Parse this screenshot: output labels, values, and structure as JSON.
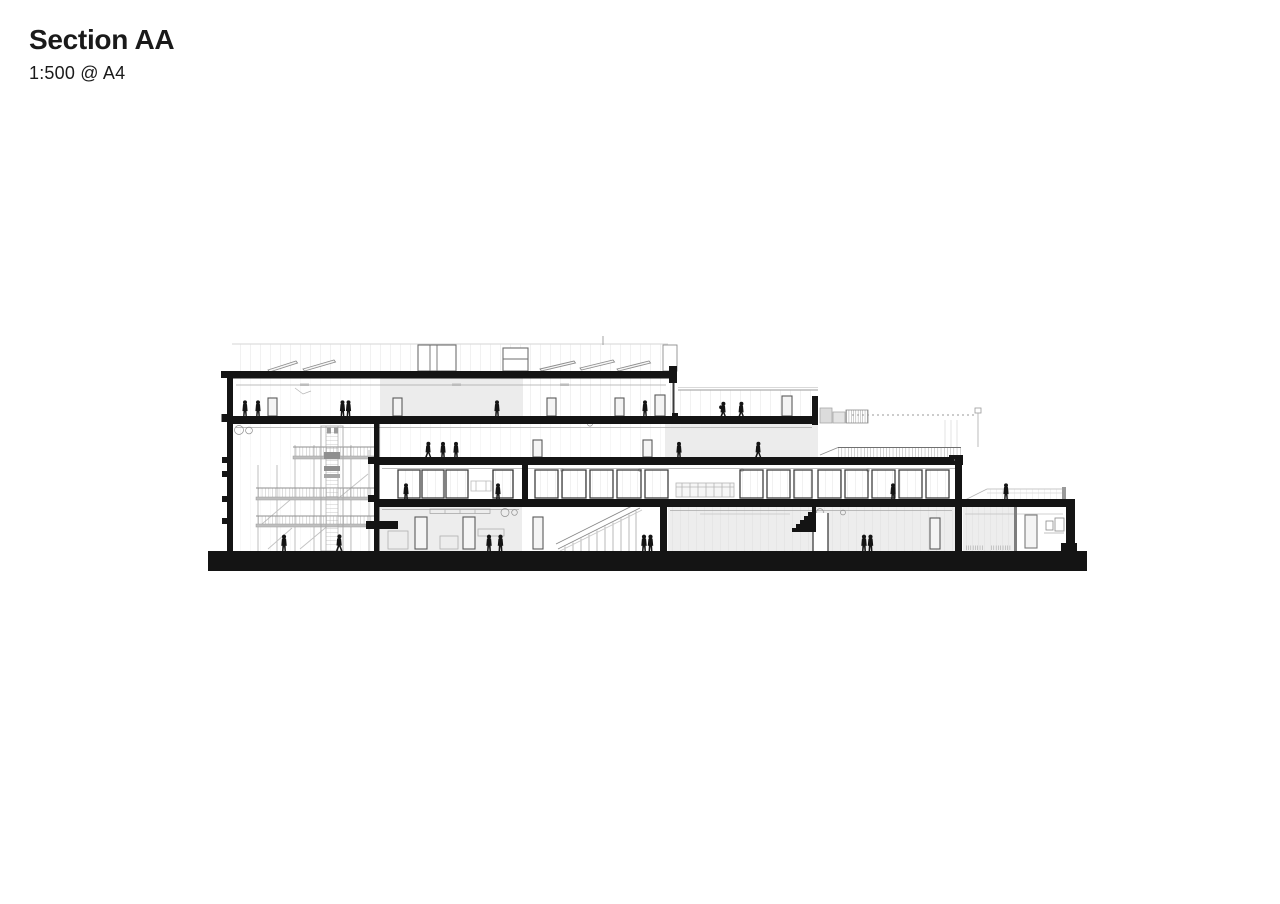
{
  "header": {
    "title": "Section AA",
    "scale": "1:500 @ A4"
  },
  "drawing": {
    "kind": "architectural-section",
    "ink_color": "#141414",
    "light_fill": "#ececec",
    "faint_line_color": "#d9d9d9"
  }
}
